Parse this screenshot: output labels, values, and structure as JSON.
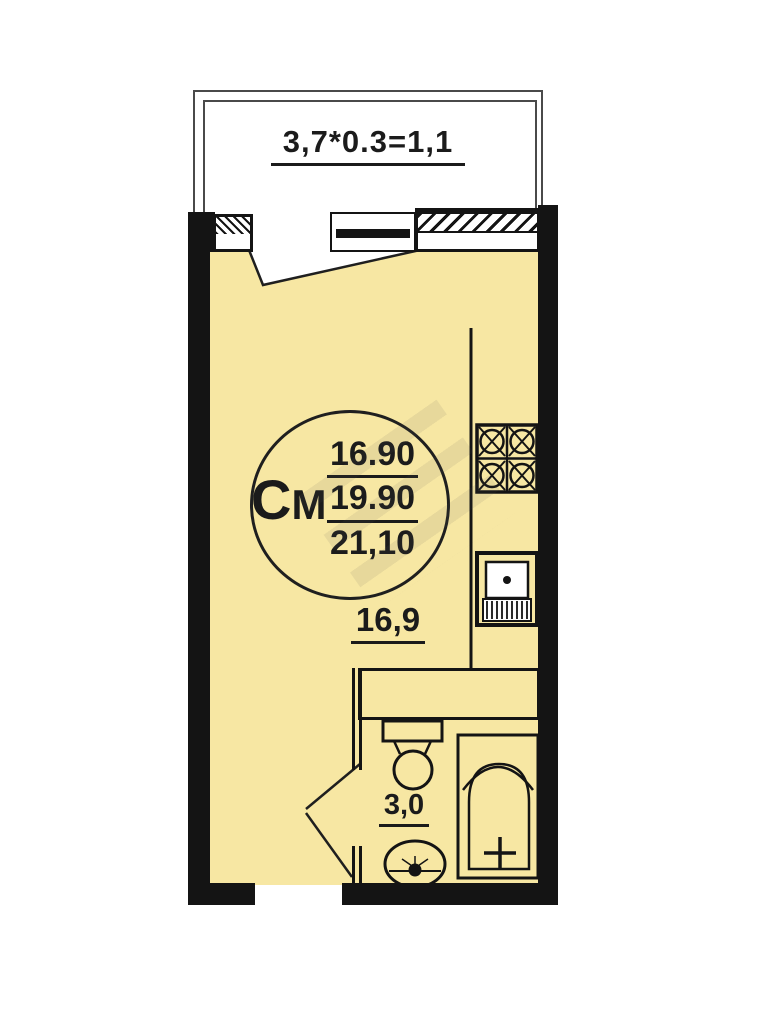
{
  "balcony": {
    "dimension_label": "3,7*0.3=1,1"
  },
  "stamp": {
    "type_label": "СМ",
    "type_letter_large": "С",
    "type_letter_small": "М",
    "values": [
      "16.90",
      "19.90",
      "21,10"
    ]
  },
  "room": {
    "area_label": "16,9"
  },
  "bathroom": {
    "area_label": "3,0"
  },
  "colors": {
    "background": "#FFFFFF",
    "room_fill": "#F7E7A3",
    "wall": "#141414",
    "line": "#1A1A1A",
    "balcony_line": "#4A4A4A"
  },
  "icons": {
    "window": "window-icon",
    "balcony_door": "balcony-door-icon",
    "stove": "stove-icon",
    "kitchen_sink": "kitchen-sink-icon",
    "toilet": "toilet-icon",
    "washbasin": "washbasin-icon",
    "bathtub": "bathtub-icon"
  }
}
